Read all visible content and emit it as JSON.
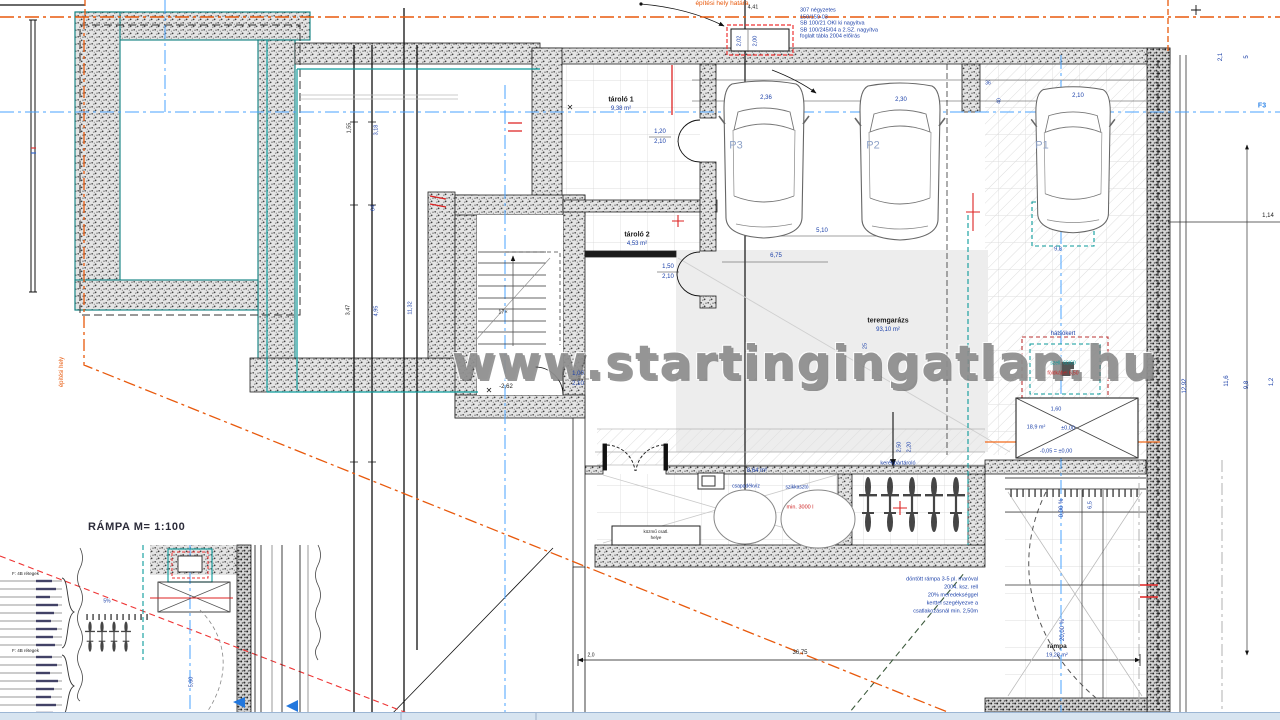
{
  "watermark": {
    "text": "www.startingingatlan.hu"
  },
  "section_title": {
    "text": "RÁMPA M= 1:100"
  },
  "colors": {
    "dim_blue": "#1a3fa8",
    "axis_blue": "#4aa3ff",
    "boundary_orange": "#e8590c",
    "marker_red": "#cc2222",
    "overlay_teal": "#0a9a9a",
    "parking_gray_blue": "#8fa3c8"
  },
  "rooms": [
    {
      "name": "tároló 1",
      "area": "9,38 m²"
    },
    {
      "name": "tároló 2",
      "area": "4,53 m²"
    },
    {
      "name": "teremgarázs",
      "area": "93,10 m²"
    },
    {
      "name": "rámpa",
      "area": "19,28 m²"
    },
    {
      "name": "kerékpártároló",
      "area": ""
    },
    {
      "name": "csapadékvíz szikkasztó",
      "area": "8,64 m²"
    }
  ],
  "parking_spots": [
    "P1",
    "P2",
    "P3"
  ],
  "annotations": [
    {
      "t": "építési hely határa",
      "x": 722,
      "y": 4,
      "s": 6.5,
      "c": "o"
    },
    {
      "t": "307 négyzetes",
      "x": 800,
      "y": 11,
      "s": 5.5,
      "c": "b",
      "a": "left"
    },
    {
      "t": "150/150-03",
      "x": 800,
      "y": 17.5,
      "s": 5.5,
      "c": "b",
      "a": "left"
    },
    {
      "t": "SB 100/21 OKI ki nagyítva",
      "x": 800,
      "y": 24,
      "s": 5.5,
      "c": "b",
      "a": "left"
    },
    {
      "t": "SB 100/245/04 a 2.SZ. nagyítva",
      "x": 800,
      "y": 30.5,
      "s": 5.5,
      "c": "b",
      "a": "left"
    },
    {
      "t": "foglalt tábla 2004 előírás",
      "x": 800,
      "y": 37,
      "s": 5.5,
      "c": "b",
      "a": "left"
    },
    {
      "t": "4,41",
      "x": 753,
      "y": 8,
      "s": 5.5,
      "c": "k"
    },
    {
      "t": "2,02",
      "x": 740,
      "y": 41,
      "s": 5.5,
      "c": "b",
      "r": -90
    },
    {
      "t": "2,00",
      "x": 756,
      "y": 41,
      "s": 5.5,
      "c": "b",
      "r": -90
    },
    {
      "t": "2,36",
      "x": 766,
      "y": 98,
      "s": 6,
      "c": "b"
    },
    {
      "t": "2,30",
      "x": 901,
      "y": 100,
      "s": 6,
      "c": "b"
    },
    {
      "t": "2,10",
      "x": 1078,
      "y": 96,
      "s": 6,
      "c": "b"
    },
    {
      "t": "P3",
      "x": 736,
      "y": 146,
      "s": 11,
      "c": "g"
    },
    {
      "t": "P2",
      "x": 873,
      "y": 146,
      "s": 11,
      "c": "g"
    },
    {
      "t": "P1",
      "x": 1042,
      "y": 146,
      "s": 11,
      "c": "g"
    },
    {
      "t": "5,10",
      "x": 822,
      "y": 231,
      "s": 6,
      "c": "b"
    },
    {
      "t": "6,75",
      "x": 776,
      "y": 256,
      "s": 6,
      "c": "b"
    },
    {
      "t": "9,8",
      "x": 1058,
      "y": 250,
      "s": 5.5,
      "c": "b"
    },
    {
      "t": "36",
      "x": 988,
      "y": 84,
      "s": 5,
      "c": "b"
    },
    {
      "t": "40",
      "x": 1000,
      "y": 101,
      "s": 5,
      "c": "b",
      "r": -90
    },
    {
      "t": "tároló 1",
      "x": 621,
      "y": 100,
      "s": 7,
      "c": "k",
      "w": 700
    },
    {
      "t": "9,38 m²",
      "x": 621,
      "y": 109,
      "s": 6,
      "c": "b"
    },
    {
      "t": "1,20",
      "x": 660,
      "y": 132,
      "s": 6,
      "c": "b"
    },
    {
      "t": "2,10",
      "x": 660,
      "y": 142,
      "s": 6,
      "c": "b"
    },
    {
      "t": "✕",
      "x": 570,
      "y": 108,
      "s": 8,
      "c": "k"
    },
    {
      "t": "tároló 2",
      "x": 637,
      "y": 235,
      "s": 7,
      "c": "k",
      "w": 700
    },
    {
      "t": "4,53 m²",
      "x": 637,
      "y": 244,
      "s": 6,
      "c": "b"
    },
    {
      "t": "1,50",
      "x": 668,
      "y": 267,
      "s": 6,
      "c": "b"
    },
    {
      "t": "2,10",
      "x": 668,
      "y": 277,
      "s": 6,
      "c": "b"
    },
    {
      "t": "teremgarázs",
      "x": 888,
      "y": 321,
      "s": 7,
      "c": "k",
      "w": 700
    },
    {
      "t": "93,10 m²",
      "x": 888,
      "y": 330,
      "s": 6,
      "c": "b"
    },
    {
      "t": "25",
      "x": 866,
      "y": 346,
      "s": 5.5,
      "c": "b",
      "r": -90
    },
    {
      "t": "1,00",
      "x": 578,
      "y": 374,
      "s": 6,
      "c": "b"
    },
    {
      "t": "2,10",
      "x": 578,
      "y": 384,
      "s": 6,
      "c": "b"
    },
    {
      "t": "✕",
      "x": 489,
      "y": 391,
      "s": 8,
      "c": "k"
    },
    {
      "t": "-2,62",
      "x": 506,
      "y": 387,
      "s": 6,
      "c": "k"
    },
    {
      "t": "17×",
      "x": 503,
      "y": 313,
      "s": 5.5,
      "c": "k"
    },
    {
      "t": "hátsókert",
      "x": 1063,
      "y": 334,
      "s": 6,
      "c": "b"
    },
    {
      "t": "szell. 60/60",
      "x": 1063,
      "y": 364,
      "s": 5,
      "c": "t"
    },
    {
      "t": "földkábel 6,50",
      "x": 1063,
      "y": 374,
      "s": 5,
      "c": "r"
    },
    {
      "t": "1,60",
      "x": 1056,
      "y": 410,
      "s": 5.5,
      "c": "b"
    },
    {
      "t": "18,9 m²",
      "x": 1036,
      "y": 428,
      "s": 5.5,
      "c": "b"
    },
    {
      "t": "±0,00",
      "x": 1068,
      "y": 429,
      "s": 5.5,
      "c": "b"
    },
    {
      "t": "-0,05 = ±0,00",
      "x": 1056,
      "y": 452,
      "s": 5.5,
      "c": "b"
    },
    {
      "t": "0,00 %",
      "x": 1062,
      "y": 508,
      "s": 6,
      "c": "b",
      "r": -90
    },
    {
      "t": "6,5",
      "x": 1091,
      "y": 505,
      "s": 5.5,
      "c": "b",
      "r": -90
    },
    {
      "t": "20,00 %",
      "x": 1063,
      "y": 630,
      "s": 6,
      "c": "b",
      "r": -90
    },
    {
      "t": "rámpa",
      "x": 1057,
      "y": 647,
      "s": 6.5,
      "c": "k",
      "w": 700
    },
    {
      "t": "19,28 m²",
      "x": 1057,
      "y": 656,
      "s": 5.5,
      "c": "b"
    },
    {
      "t": "1,14",
      "x": 1268,
      "y": 216,
      "s": 6,
      "c": "k"
    },
    {
      "t": "12,92",
      "x": 1185,
      "y": 386,
      "s": 6,
      "c": "b",
      "r": -90
    },
    {
      "t": "11,6",
      "x": 1227,
      "y": 381,
      "s": 6,
      "c": "b",
      "r": -90
    },
    {
      "t": "9,8",
      "x": 1247,
      "y": 385,
      "s": 6,
      "c": "b",
      "r": -90
    },
    {
      "t": "1,2",
      "x": 1272,
      "y": 382,
      "s": 6,
      "c": "b",
      "r": -90
    },
    {
      "t": "2,1",
      "x": 1221,
      "y": 57,
      "s": 6,
      "c": "b",
      "r": -90
    },
    {
      "t": "5",
      "x": 1247,
      "y": 57,
      "s": 6,
      "c": "b",
      "r": -90
    },
    {
      "t": "F3",
      "x": 1262,
      "y": 106,
      "s": 7,
      "c": "#2f86e8",
      "w": 700
    },
    {
      "t": "1,55",
      "x": 350,
      "y": 128,
      "s": 5.5,
      "c": "k",
      "r": -90
    },
    {
      "t": "3,18",
      "x": 377,
      "y": 130,
      "s": 5.5,
      "c": "b",
      "r": -90
    },
    {
      "t": "64",
      "x": 374,
      "y": 208,
      "s": 5.5,
      "c": "b",
      "r": -90
    },
    {
      "t": "3,47",
      "x": 349,
      "y": 310,
      "s": 5.5,
      "c": "k",
      "r": -90
    },
    {
      "t": "4,95",
      "x": 377,
      "y": 311,
      "s": 5.5,
      "c": "b",
      "r": -90
    },
    {
      "t": "11,32",
      "x": 411,
      "y": 308,
      "s": 5.5,
      "c": "b",
      "r": -90
    },
    {
      "t": "építési hely",
      "x": 62,
      "y": 372,
      "s": 6,
      "c": "o",
      "r": -90
    },
    {
      "t": "8,64 m²",
      "x": 757,
      "y": 471,
      "s": 6,
      "c": "b"
    },
    {
      "t": "csapadékvíz",
      "x": 746,
      "y": 487,
      "s": 5,
      "c": "b"
    },
    {
      "t": "szikkasztó",
      "x": 797,
      "y": 488,
      "s": 5,
      "c": "b"
    },
    {
      "t": "min. 3000 l",
      "x": 800,
      "y": 508,
      "s": 5.5,
      "c": "r"
    },
    {
      "t": "kerékpártároló",
      "x": 898,
      "y": 464,
      "s": 5.5,
      "c": "b"
    },
    {
      "t": "közmű csatl.",
      "x": 656,
      "y": 532,
      "s": 4.5,
      "c": "k"
    },
    {
      "t": "helye",
      "x": 656,
      "y": 538,
      "s": 4.5,
      "c": "k"
    },
    {
      "t": "2,50",
      "x": 900,
      "y": 447,
      "s": 5.5,
      "c": "b",
      "r": -90
    },
    {
      "t": "2,20",
      "x": 910,
      "y": 447,
      "s": 5.5,
      "c": "b",
      "r": -90
    },
    {
      "t": "döntött rámpa 3-5 pl. maróval",
      "x": 978,
      "y": 580,
      "s": 5.5,
      "c": "b",
      "a": "right"
    },
    {
      "t": "2004. ksz. rell",
      "x": 978,
      "y": 588,
      "s": 5.5,
      "c": "b",
      "a": "right"
    },
    {
      "t": "20% meredekséggel",
      "x": 978,
      "y": 596,
      "s": 5.5,
      "c": "b",
      "a": "right"
    },
    {
      "t": "kerttel szegélyezve a",
      "x": 978,
      "y": 604,
      "s": 5.5,
      "c": "b",
      "a": "right"
    },
    {
      "t": "csatlakozásnál min. 2,50m",
      "x": 978,
      "y": 612,
      "s": 5.5,
      "c": "b",
      "a": "right"
    },
    {
      "t": "36,75",
      "x": 800,
      "y": 653,
      "s": 6,
      "c": "k"
    },
    {
      "t": "2,0",
      "x": 591,
      "y": 656,
      "s": 5,
      "c": "k"
    },
    {
      "t": "5,60",
      "x": 192,
      "y": 682,
      "s": 5.5,
      "c": "b",
      "r": -90
    },
    {
      "t": "5%",
      "x": 107,
      "y": 602,
      "s": 5,
      "c": "b"
    },
    {
      "t": "F: 4B rétegek",
      "x": 12,
      "y": 574,
      "s": 4.5,
      "c": "k",
      "a": "left"
    },
    {
      "t": "F: 4B rétegek",
      "x": 12,
      "y": 651,
      "s": 4.5,
      "c": "k",
      "a": "left"
    }
  ]
}
